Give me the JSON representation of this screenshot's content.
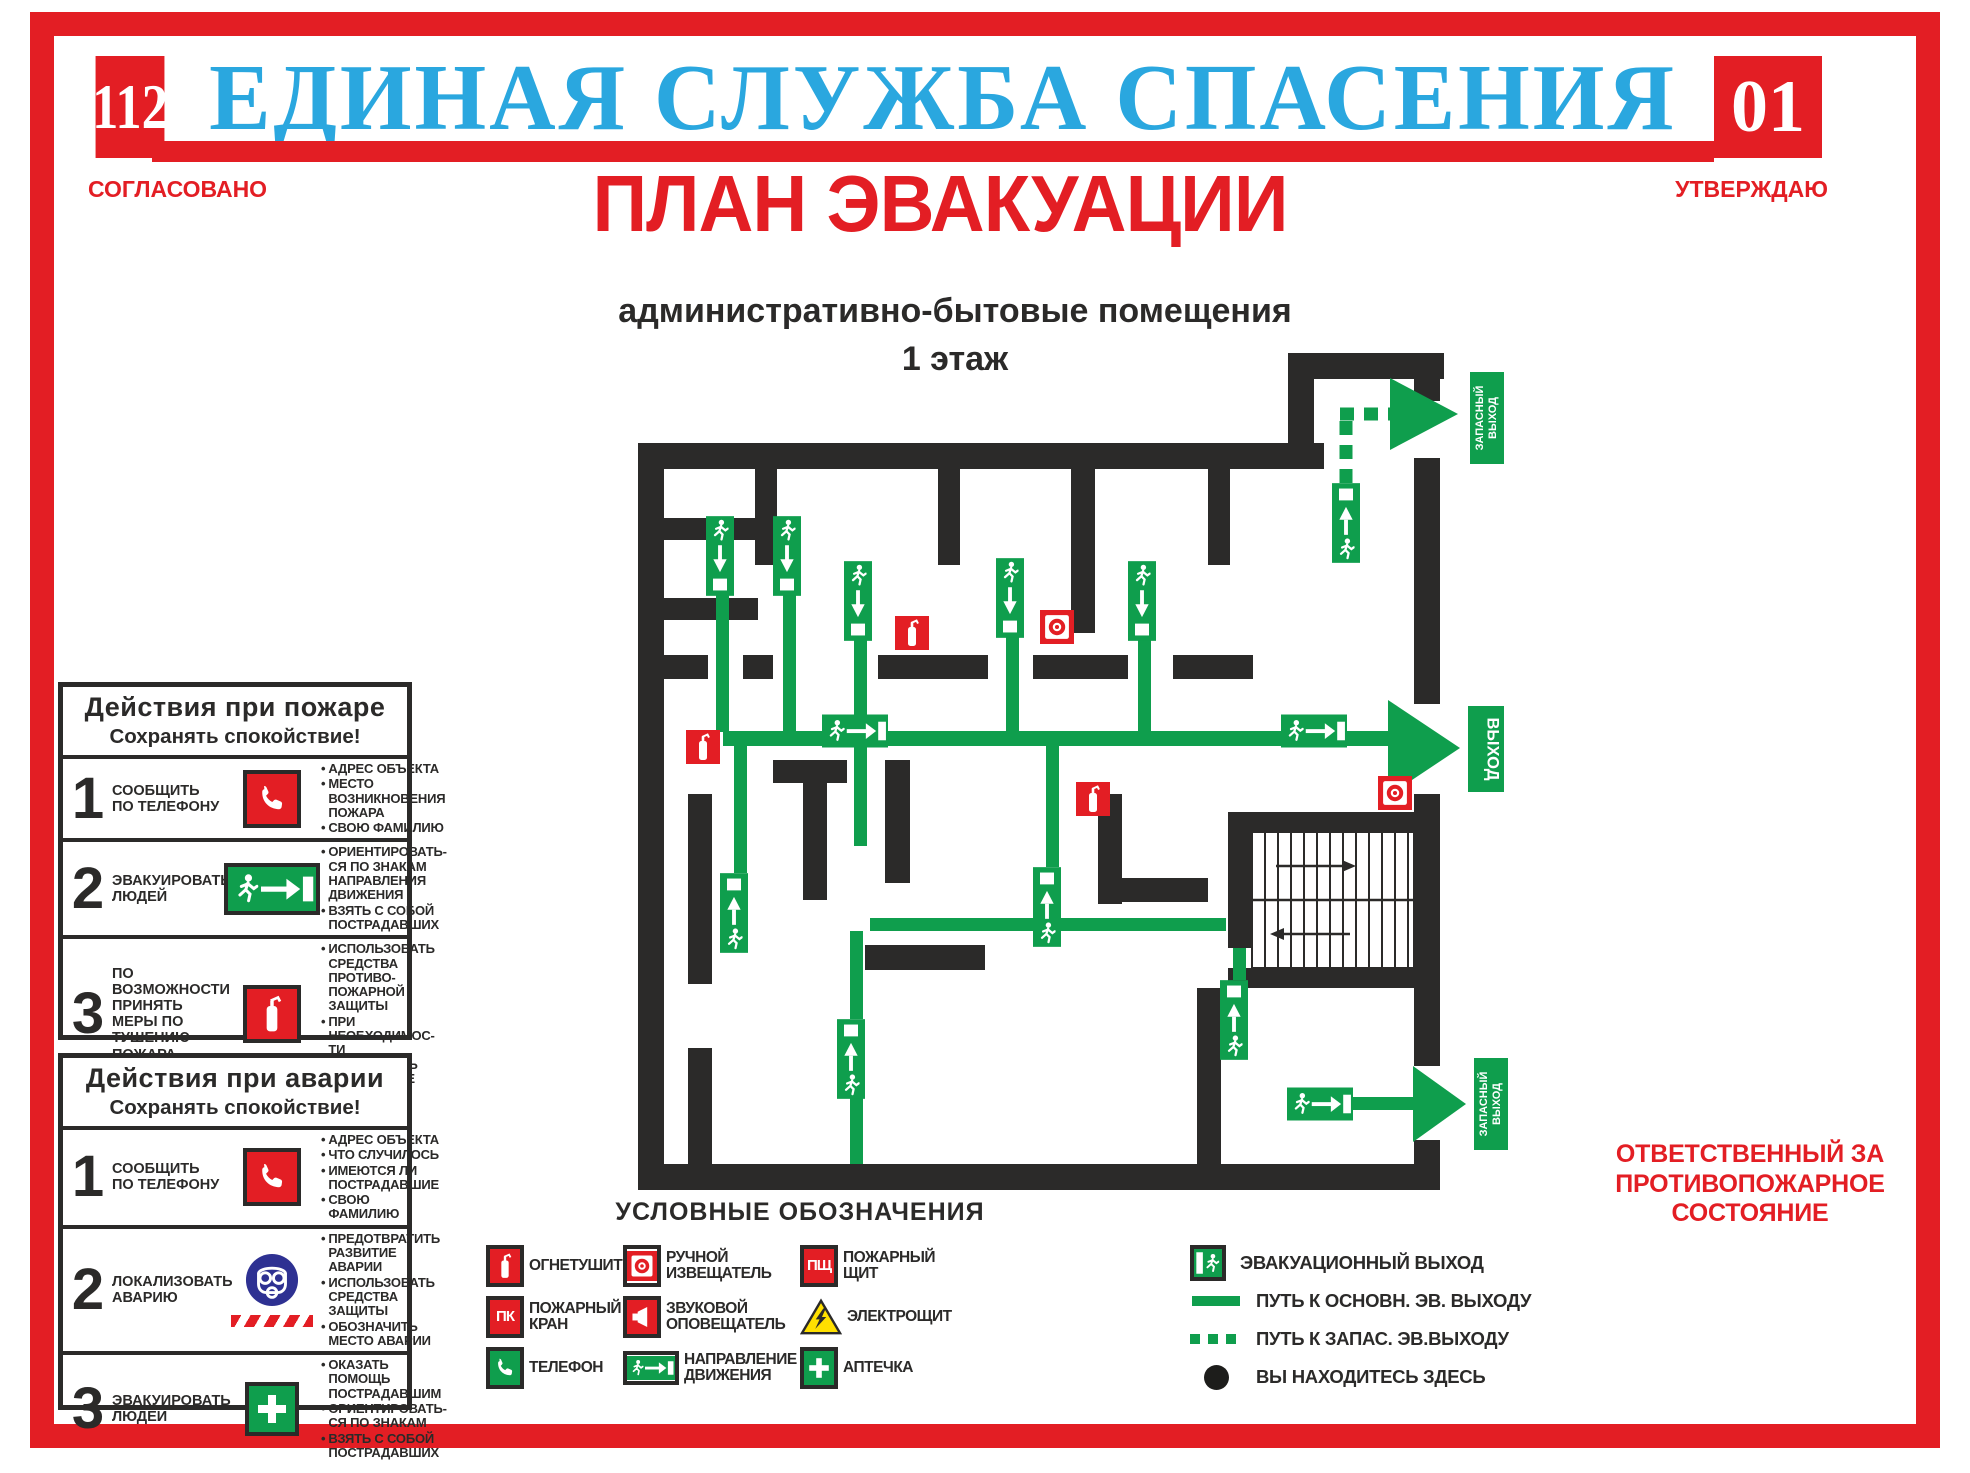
{
  "colors": {
    "red": "#E31E24",
    "blue": "#2AA7DF",
    "green": "#0F9E4D",
    "wall": "#2B2A29",
    "yellow": "#FFE000",
    "mask": "#2E3192"
  },
  "header": {
    "code_left": "112",
    "code_right": "01",
    "title": "ЕДИНАЯ СЛУЖБА СПАСЕНИЯ",
    "agreed": "СОГЛАСОВАНО",
    "approved": "УТВЕРЖДАЮ"
  },
  "title": "ПЛАН ЭВАКУАЦИИ",
  "subtitle": "административно-бытовые помещения",
  "floor": "1 этаж",
  "action_boxes": [
    {
      "title": "Действия при пожаре",
      "subtitle": "Сохранять спокойствие!",
      "steps": [
        {
          "number": "1",
          "action": "СООБЩИТЬ ПО ТЕЛЕФОНУ",
          "icon": "phone-red",
          "bullets": [
            "АДРЕС ОБЪЕКТА",
            "МЕСТО ВОЗНИКНОВЕНИЯ ПОЖАРА",
            "СВОЮ ФАМИЛИЮ"
          ]
        },
        {
          "number": "2",
          "action": "ЭВАКУИРОВАТЬ ЛЮДЕЙ",
          "icon": "exit-sign",
          "bullets": [
            "ОРИЕНТИРОВАТЬ-СЯ ПО ЗНАКАМ НАПРАВЛЕНИЯ ДВИЖЕНИЯ",
            "ВЗЯТЬ С СОБОЙ ПОСТРАДАВШИХ"
          ]
        },
        {
          "number": "3",
          "action": "ПО ВОЗМОЖНОСТИ ПРИНЯТЬ МЕРЫ ПО ТУШЕНИЮ ПОЖАРА",
          "icon": "extinguisher",
          "bullets": [
            "ИСПОЛЬЗОВАТЬ СРЕДСТВА ПРОТИВО-ПОЖАРНОЙ ЗАЩИТЫ",
            "ПРИ НЕОБХОДИМОС-ТИ ОБЕСПЕЧИТЬ ПОМЕЩЕНИЕ"
          ]
        }
      ]
    },
    {
      "title": "Действия при аварии",
      "subtitle": "Сохранять спокойствие!",
      "steps": [
        {
          "number": "1",
          "action": "СООБЩИТЬ ПО ТЕЛЕФОНУ",
          "icon": "phone-red",
          "bullets": [
            "АДРЕС ОБЪЕКТА",
            "ЧТО СЛУЧИЛОСЬ",
            "ИМЕЮТСЯ ЛИ ПОСТРАДАВШИЕ",
            "СВОЮ ФАМИЛИЮ"
          ]
        },
        {
          "number": "2",
          "action": "ЛОКАЛИЗОВАТЬ АВАРИЮ",
          "icon": "gas-mask",
          "bullets": [
            "ПРЕДОТВРАТИТЬ РАЗВИТИЕ АВАРИИ",
            "ИСПОЛЬЗОВАТЬ СРЕДСТВА ЗАЩИТЫ",
            "ОБОЗНАЧИТЬ МЕСТО АВАРИИ"
          ]
        },
        {
          "number": "3",
          "action": "ЭВАКУИРОВАТЬ ЛЮДЕЙ",
          "icon": "first-aid",
          "bullets": [
            "ОКАЗАТЬ ПОМОЩЬ ПОСТРАДАВШИМ",
            "ОРИЕНТИРОВАТЬ-СЯ ПО ЗНАКАМ",
            "ВЗЯТЬ С СОБОЙ ПОСТРАДАВШИХ"
          ]
        }
      ]
    }
  ],
  "plan": {
    "exit_label": "ВЫХОД",
    "emergency_exit_word1": "ЗАПАСНЫЙ",
    "emergency_exit_word2": "ВЫХОД"
  },
  "legend": {
    "title": "УСЛОВНЫЕ ОБОЗНАЧЕНИЯ",
    "left_items": [
      {
        "icon": "extinguisher",
        "label": "ОГНЕТУШИТЕЛЬ"
      },
      {
        "icon": "call-point",
        "label": "РУЧНОЙ ИЗВЕЩАТЕЛЬ"
      },
      {
        "icon": "fire-shield",
        "text": "ПЩ",
        "label": "ПОЖАРНЫЙ ЩИТ"
      },
      {
        "icon": "fire-hydrant",
        "text": "ПК",
        "label": "ПОЖАРНЫЙ КРАН"
      },
      {
        "icon": "sounder",
        "label": "ЗВУКОВОЙ ОПОВЕЩАТЕЛЬ"
      },
      {
        "icon": "electro-panel",
        "label": "ЭЛЕКТРОЩИТ"
      },
      {
        "icon": "phone-green",
        "label": "ТЕЛЕФОН"
      },
      {
        "icon": "direction-sign",
        "label": "НАПРАВЛЕНИЕ ДВИЖЕНИЯ"
      },
      {
        "icon": "first-aid",
        "label": "АПТЕЧКА"
      }
    ],
    "right_items": [
      {
        "icon": "evac-exit",
        "label": "ЭВАКУАЦИОННЫЙ ВЫХОД"
      },
      {
        "icon": "line-solid",
        "label": "ПУТЬ К ОСНОВН. ЭВ. ВЫХОДУ"
      },
      {
        "icon": "line-dashed",
        "label": "ПУТЬ К ЗАПАС. ЭВ.ВЫХОДУ"
      },
      {
        "icon": "you-are-here",
        "label": "ВЫ НАХОДИТЕСЬ ЗДЕСЬ"
      }
    ]
  },
  "footer": {
    "line1": "ОТВЕТСТВЕННЫЙ ЗА",
    "line2": "ПРОТИВОПОЖАРНОЕ",
    "line3": "СОСТОЯНИЕ"
  }
}
